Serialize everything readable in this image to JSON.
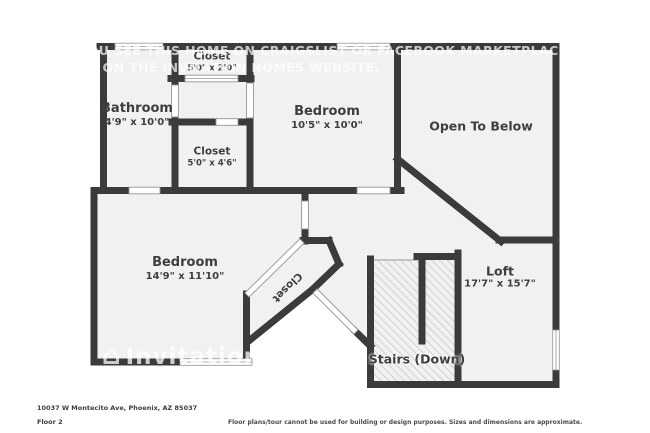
{
  "plan": {
    "colors": {
      "wall": "#3b3b3b",
      "floor": "#f2f1ef",
      "hatch": "#b3b3b3",
      "thin": "#949494"
    },
    "watermark": {
      "line1": "IF YOU SEE THIS HOME ON CRAIGSLIST OR FACEBOOK MARKETPLACE, IT IS FRAUD. APPLY",
      "line2": "ONLY ON THE INVITATION HOMES WEBSITE.",
      "logo": "Invitation Homes"
    },
    "rooms": [
      {
        "name": "Closet",
        "dims": "5'0\" x 2'0\""
      },
      {
        "name": "Bathroom",
        "dims": "4'9\" x 10'0\""
      },
      {
        "name": "Closet",
        "dims": "5'0\" x 4'6\""
      },
      {
        "name": "Bedroom",
        "dims": "10'5\" x 10'0\""
      },
      {
        "name": "Open To Below",
        "dims": ""
      },
      {
        "name": "Bedroom",
        "dims": "14'9\" x 11'10\""
      },
      {
        "name": "Closet",
        "dims": ""
      },
      {
        "name": "Loft",
        "dims": "17'7\" x 15'7\""
      },
      {
        "name": "Stairs (Down)",
        "dims": ""
      }
    ]
  },
  "footer": {
    "address": "10037 W Montecito Ave, Phoenix, AZ 85037",
    "floor_label": "Floor 2",
    "disclaimer": "Floor plans/tour cannot be used for building or design purposes. Sizes and dimensions are approximate."
  }
}
